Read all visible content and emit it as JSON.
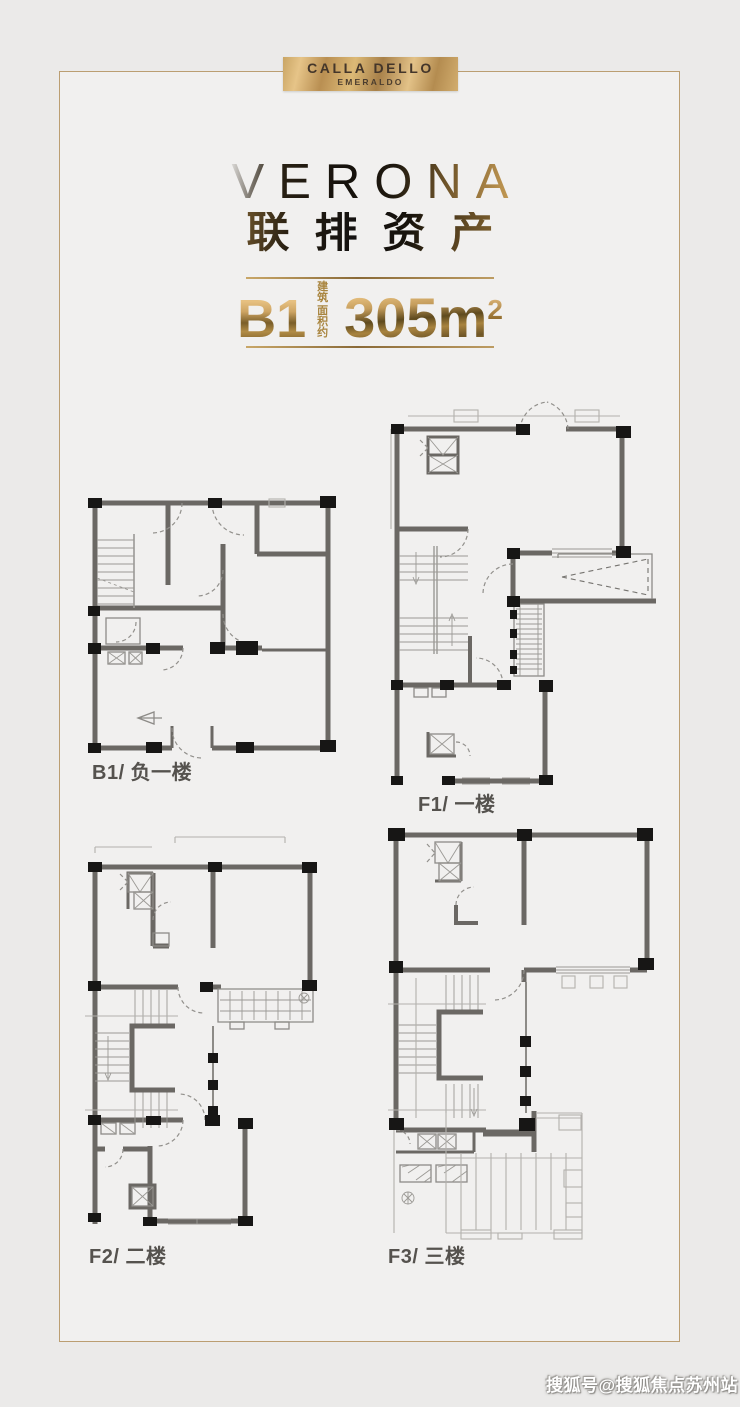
{
  "colors": {
    "accent_gold": "#bb9e72",
    "gold_dark": "#8a6a38",
    "title_dark": "#15110c",
    "wall_gray": "#6b6864",
    "column_black": "#171615",
    "label_gray": "#55524e",
    "background": "#ebeae9",
    "panel": "#f1f0ef",
    "watermark_white": "#ffffff"
  },
  "logo": {
    "line1": "CALLA DELLO",
    "line2": "EMERALDO"
  },
  "title": {
    "en": "VERONA",
    "cn": "联排资产"
  },
  "spec": {
    "unit": "B1",
    "prefix_line1": "建 筑",
    "prefix_line2": "面积约",
    "area": "305m",
    "area_sup": "2"
  },
  "plans": [
    {
      "id": "b1",
      "label": "B1/ 负一楼"
    },
    {
      "id": "f1",
      "label": "F1/ 一楼"
    },
    {
      "id": "f2",
      "label": "F2/ 二楼"
    },
    {
      "id": "f3",
      "label": "F3/ 三楼"
    }
  ],
  "watermark": "搜狐号@搜狐焦点苏州站"
}
